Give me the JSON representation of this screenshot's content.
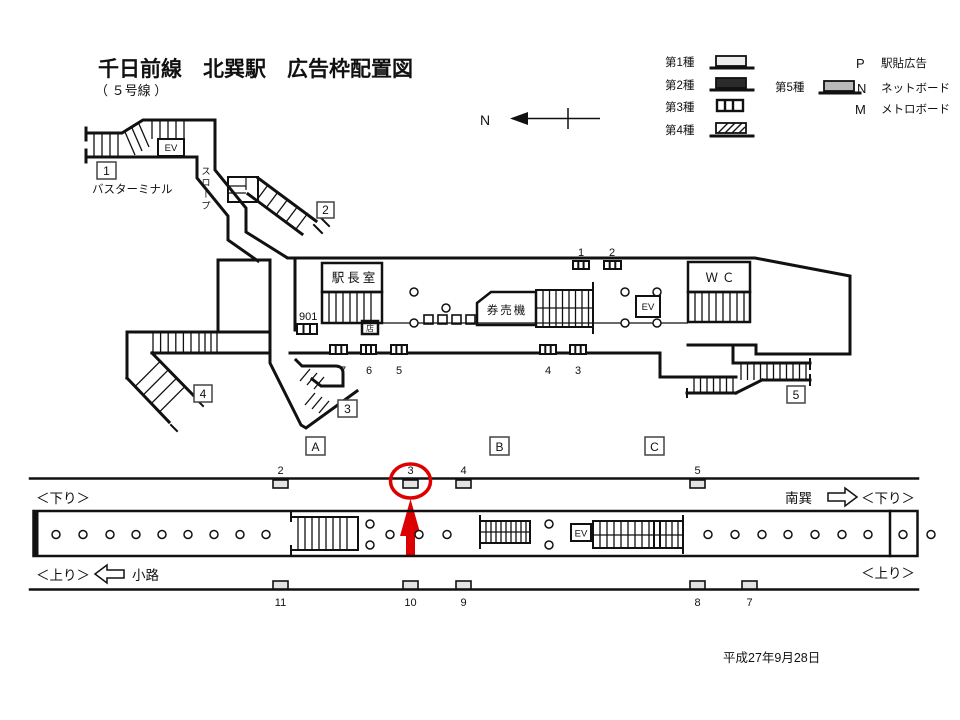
{
  "header": {
    "title": "千日前線　北巽駅　広告枠配置図",
    "subtitle": "（ ５号線 ）"
  },
  "meta": {
    "date": "平成27年9月28日"
  },
  "compass": {
    "label": "N"
  },
  "legend": {
    "types": [
      {
        "label": "第1種"
      },
      {
        "label": "第2種"
      },
      {
        "label": "第3種"
      },
      {
        "label": "第4種"
      },
      {
        "label": "第5種"
      }
    ],
    "codes": [
      {
        "code": "P",
        "desc": "駅貼広告"
      },
      {
        "code": "N",
        "desc": "ネットボード"
      },
      {
        "code": "M",
        "desc": "メトロボード"
      }
    ]
  },
  "station": {
    "exits": [
      "1",
      "2",
      "3",
      "4",
      "5"
    ],
    "bus_terminal": "バスターミナル",
    "slope": "スロープ",
    "ev": "EV",
    "station_office": "駅長室",
    "office_ad": "901",
    "kiosk": "店",
    "ticket_machines": "券売機",
    "wc": "ＷＣ",
    "wall_ads_top": [
      "1",
      "2"
    ],
    "wall_ads_bottom": [
      "7",
      "6",
      "5",
      "4",
      "3"
    ]
  },
  "platform": {
    "sections": [
      "A",
      "B",
      "C"
    ],
    "ev": "EV",
    "ads_top": [
      "2",
      "3",
      "4",
      "5"
    ],
    "ads_bottom": [
      "11",
      "10",
      "9",
      "8",
      "7"
    ],
    "down_left": "＜下り＞",
    "down_right": "＜下り＞",
    "up_left": "＜上り＞",
    "up_right": "＜上り＞",
    "next_station_right": "南巽",
    "next_station_left": "小路",
    "highlighted_ad": "3"
  },
  "colors": {
    "ink": "#111111",
    "highlight": "#dd0000",
    "ad_light": "#e3e3e3",
    "ad_dark": "#2b2b2b",
    "ad_gray": "#b9b9b9"
  }
}
